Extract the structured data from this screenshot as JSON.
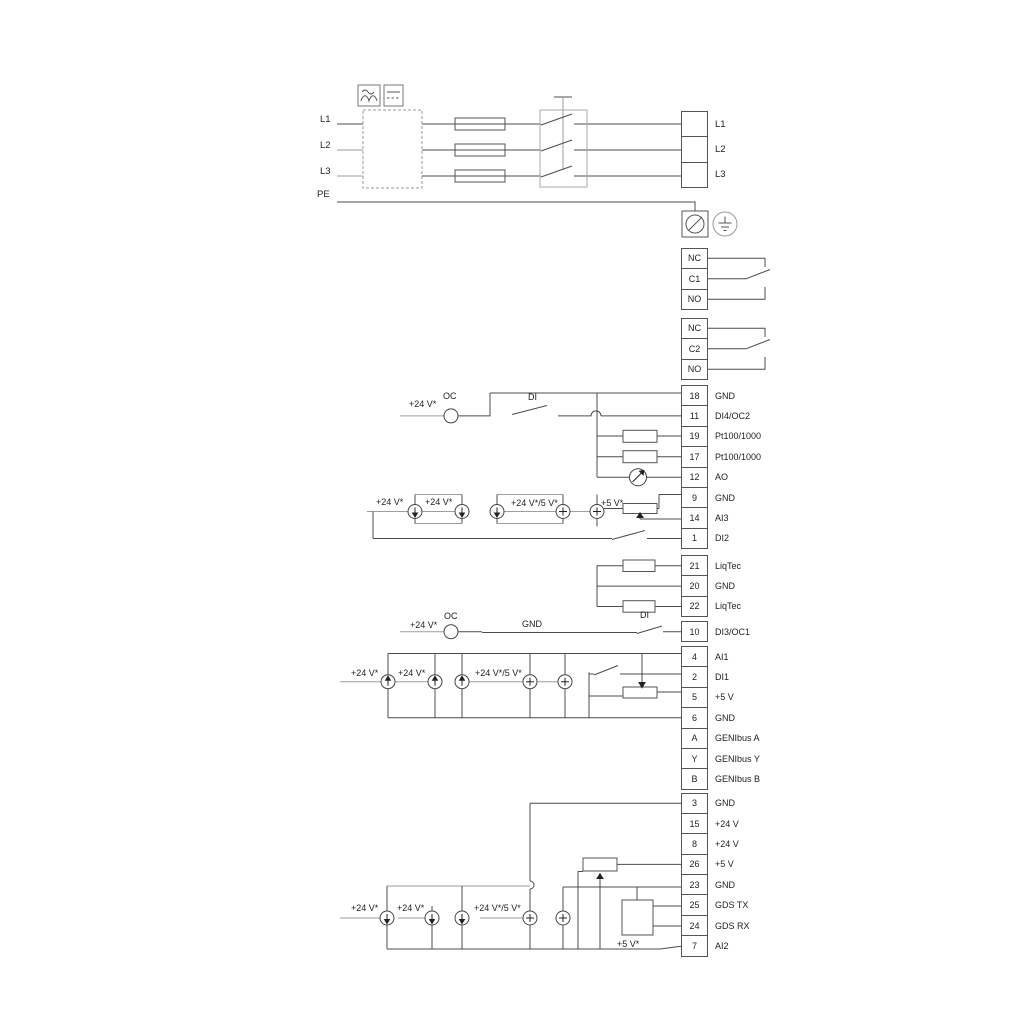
{
  "power": {
    "input_labels": [
      "L1",
      "L2",
      "L3",
      "PE"
    ],
    "output_labels": [
      "L1",
      "L2",
      "L3"
    ]
  },
  "relays": {
    "relay1": [
      "NC",
      "C1",
      "NO"
    ],
    "relay2": [
      "NC",
      "C2",
      "NO"
    ]
  },
  "strips": {
    "io1": [
      {
        "no": "18",
        "label": "GND"
      },
      {
        "no": "11",
        "label": "DI4/OC2"
      },
      {
        "no": "19",
        "label": "Pt100/1000"
      },
      {
        "no": "17",
        "label": "Pt100/1000"
      },
      {
        "no": "12",
        "label": "AO"
      },
      {
        "no": "9",
        "label": "GND"
      },
      {
        "no": "14",
        "label": "AI3"
      },
      {
        "no": "1",
        "label": "DI2"
      }
    ],
    "liqtec": [
      {
        "no": "21",
        "label": "LiqTec"
      },
      {
        "no": "20",
        "label": "GND"
      },
      {
        "no": "22",
        "label": "LiqTec"
      }
    ],
    "di3": [
      {
        "no": "10",
        "label": "DI3/OC1"
      }
    ],
    "io2": [
      {
        "no": "4",
        "label": "AI1"
      },
      {
        "no": "2",
        "label": "DI1"
      },
      {
        "no": "5",
        "label": "+5 V"
      },
      {
        "no": "6",
        "label": "GND"
      },
      {
        "no": "A",
        "label": "GENIbus A"
      },
      {
        "no": "Y",
        "label": "GENIbus Y"
      },
      {
        "no": "B",
        "label": "GENIbus B"
      }
    ],
    "io3": [
      {
        "no": "3",
        "label": "GND"
      },
      {
        "no": "15",
        "label": "+24 V"
      },
      {
        "no": "8",
        "label": "+24 V"
      },
      {
        "no": "26",
        "label": "+5 V"
      },
      {
        "no": "23",
        "label": "GND"
      },
      {
        "no": "25",
        "label": "GDS TX"
      },
      {
        "no": "24",
        "label": "GDS RX"
      },
      {
        "no": "7",
        "label": "AI2"
      }
    ]
  },
  "annotations": {
    "v24": "+24 V*",
    "oc": "OC",
    "di": "DI",
    "gnd": "GND",
    "v24_5": "+24 V*/5 V*",
    "v5": "+5 V*"
  },
  "colors": {
    "wire_dark": "#4c4c4c",
    "wire_grey": "#9e9e9e",
    "text": "#222222"
  }
}
